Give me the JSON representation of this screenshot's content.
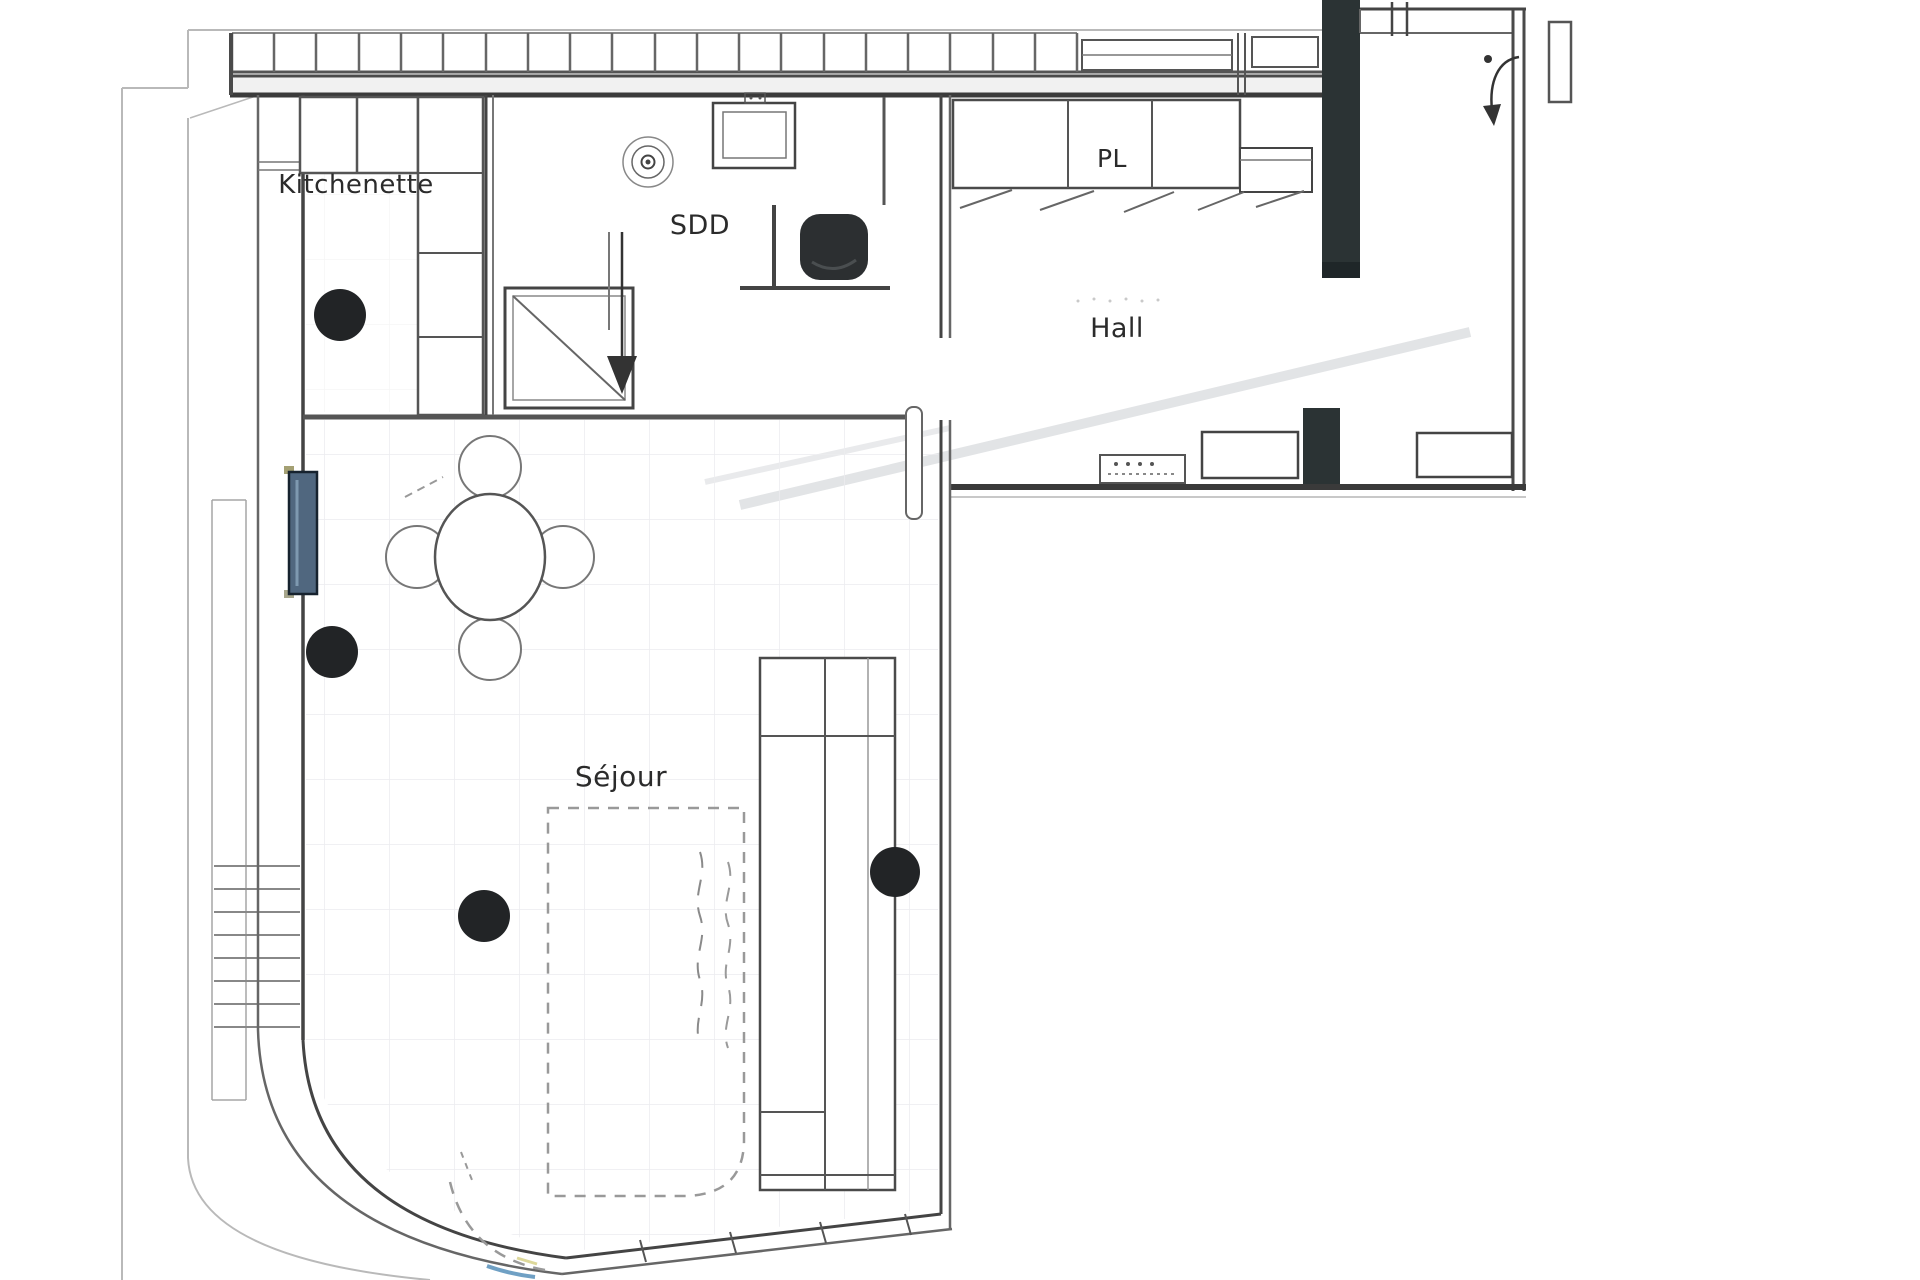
{
  "document": {
    "kind": "scanned architectural floor plan"
  },
  "rooms": {
    "kitchenette": {
      "label": "Kitchenette"
    },
    "sdd": {
      "label": "SDD"
    },
    "pl": {
      "label": "PL"
    },
    "hall": {
      "label": "Hall"
    },
    "sejour": {
      "label": "Séjour"
    }
  },
  "colors": {
    "pillar": "#2b3334",
    "pillar_cap": "#1f2628",
    "ceiling_light": "#222426",
    "radiator_blue": "#50677f",
    "toilet_dark": "#2c2f31",
    "wall_dark": "#3b3b3b",
    "grid_line": "#ececef"
  },
  "ceiling_lights": [
    {
      "x": 340,
      "y": 315,
      "r": 26
    },
    {
      "x": 332,
      "y": 652,
      "r": 26
    },
    {
      "x": 484,
      "y": 916,
      "r": 26
    },
    {
      "x": 895,
      "y": 872,
      "r": 25
    }
  ]
}
